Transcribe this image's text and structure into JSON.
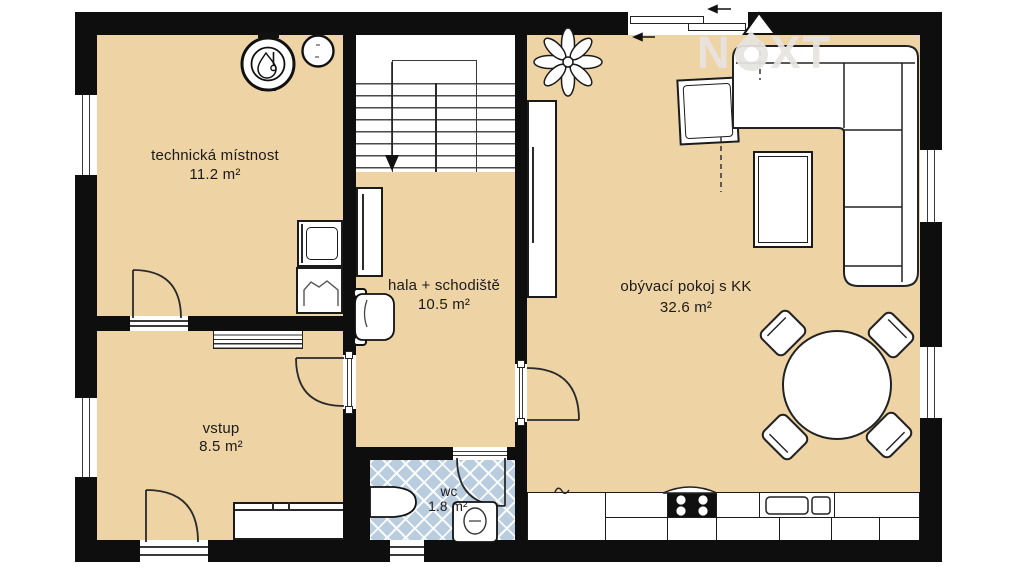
{
  "watermark": {
    "part1": "N",
    "part2": "XT"
  },
  "rooms": {
    "technicka": {
      "name": "technická místnost",
      "area": "11.2 m²"
    },
    "hala": {
      "name": "hala + schodiště",
      "area": "10.5 m²"
    },
    "obyvaci": {
      "name": "obývací pokoj s KK",
      "area": "32.6 m²"
    },
    "vstup": {
      "name": "vstup",
      "area": "8.5 m²"
    },
    "wc": {
      "name": "wc",
      "area": "1.8 m²"
    }
  },
  "colors": {
    "floor": "#eed3a4",
    "wall": "#0e0e0e",
    "wc_tile": "#b9cdde",
    "watermark": "#e7e5e1",
    "outline": "#1b1b1b"
  },
  "icons": [
    "boiler-icon",
    "expansion-vessel-icon",
    "washing-machine-icon",
    "laundry-basket-icon",
    "stairs-icon",
    "wardrobe-icon",
    "armchair-icon",
    "doormat-icon",
    "entry-cabinet-icon",
    "shelf-cabinet-icon",
    "plant-icon",
    "corner-sofa-icon",
    "square-armchair-icon",
    "coffee-table-icon",
    "dining-table-icon",
    "dining-chair-icon",
    "kitchen-counter-icon",
    "cooktop-icon",
    "kitchen-sink-icon",
    "toilet-icon",
    "washbasin-icon",
    "door-swing-icon",
    "window-icon",
    "flue-triangle-icon",
    "stair-direction-arrow-icon"
  ]
}
